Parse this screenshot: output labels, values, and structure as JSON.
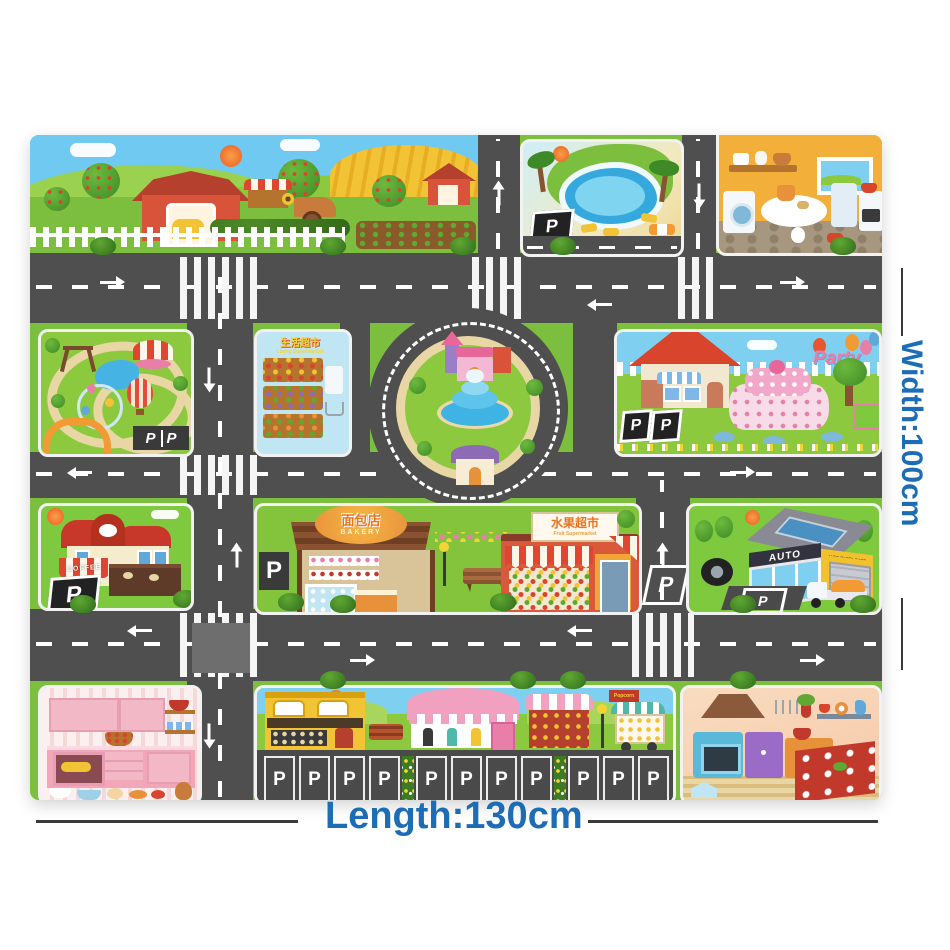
{
  "product": {
    "width_label": "Width:100cm",
    "length_label": "Length:130cm"
  },
  "signs": {
    "parking": "P",
    "living_market_cn": "生活超市",
    "living_market_en": "Living Supermarket",
    "bakery_cn": "面包店",
    "bakery_en": "BAKERY",
    "fruit_cn": "水果超市",
    "fruit_en": "Fruit Supermarket",
    "auto": "AUTO",
    "auto_sub": "AUTO PARTS SHOP",
    "coffee": "COFFEE",
    "party": "Party",
    "popcorn": "Popcorn"
  },
  "colors": {
    "label_blue": "#1C6DB5",
    "road_gray": "#4F4F4F",
    "grass_green": "#7CBF3F",
    "sky_blue": "#6FC9F1"
  }
}
